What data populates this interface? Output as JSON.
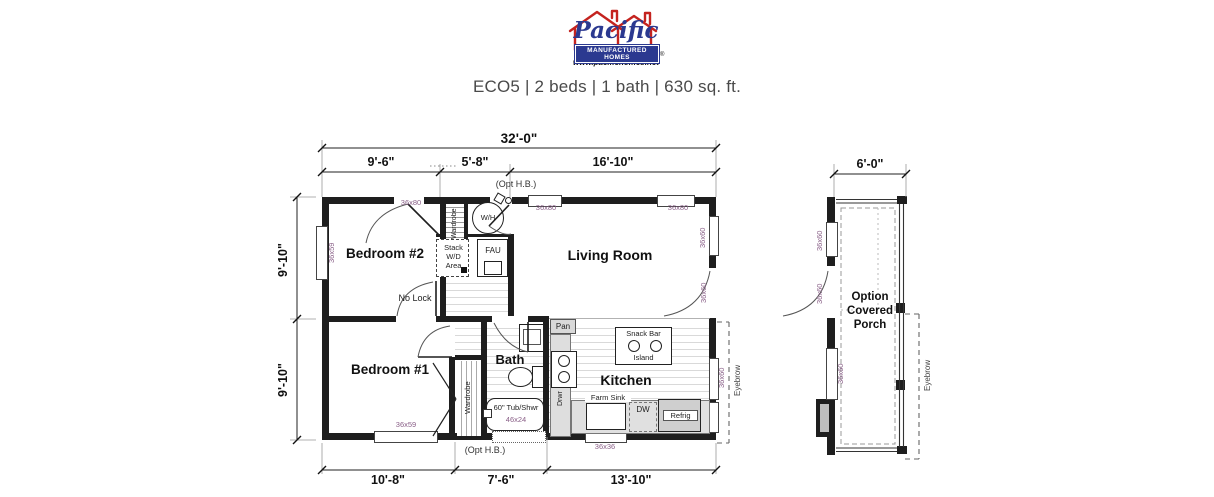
{
  "logo": {
    "brand": "Pacific",
    "banner": "MANUFACTURED HOMES",
    "website": "www.pacifichomes.net",
    "registered": "®",
    "red": "#c4231f",
    "blue": "#2b3990"
  },
  "title": "ECO5 | 2 beds | 1 bath | 630 sq. ft.",
  "dims": {
    "overall": "32'-0\"",
    "top": [
      "9'-6\"",
      "5'-8\"",
      "16'-10\""
    ],
    "left": [
      "9'-10\"",
      "9'-10\""
    ],
    "bottom": [
      "10'-8\"",
      "7'-6\"",
      "13'-10\""
    ],
    "porch": "6'-0\""
  },
  "rooms": {
    "bedroom2": "Bedroom #2",
    "living": "Living Room",
    "bedroom1": "Bedroom #1",
    "bath": "Bath",
    "kitchen": "Kitchen",
    "porch": "Option Covered Porch"
  },
  "fixtures": {
    "water_heater": "W/H",
    "fau": "FAU",
    "stack_wd": "Stack W/D Area",
    "wardrobe": "Wardrobe",
    "no_lock": "No Lock",
    "pantry": "Pan",
    "snack_bar": "Snack Bar",
    "island": "Island",
    "drawers": "Drwr",
    "farm_sink": "Farm Sink",
    "dishwasher": "DW",
    "refrigerator": "Refrig",
    "tub": "60\" Tub/Shwr",
    "tub_size": "46x24",
    "opt_hose_bib": "(Opt H.B.)",
    "eyebrow": "Eyebrow"
  },
  "openings": {
    "door_36x80": "36x80",
    "window_36x59": "36x59",
    "window_36x60": "36x60",
    "window_36x36": "36x36"
  },
  "colors": {
    "wall": "#1e1e1e",
    "opening_label": "#8a6088",
    "dimension_text": "#111111",
    "title_text": "#4a4a4a"
  }
}
